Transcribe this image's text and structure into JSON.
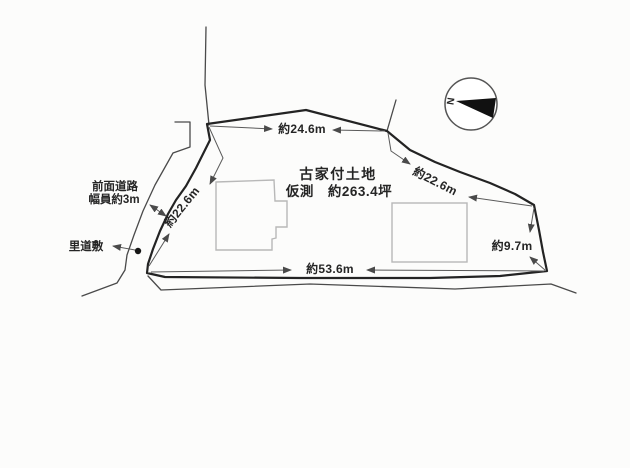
{
  "diagram": {
    "title": "土地区画図",
    "center_label": {
      "line1": "古家付土地",
      "line2": "仮測　約263.4坪"
    },
    "dimensions": {
      "top": "約24.6m",
      "left_edge": "約22.6m",
      "right_edge": "約22.6m",
      "right_short": "約9.7m",
      "bottom": "約53.6m"
    },
    "roads": {
      "front_road_line1": "前面道路",
      "front_road_line2": "幅員約3m",
      "rido_label": "里道敷"
    },
    "compass": {
      "north_label": "N"
    },
    "colors": {
      "background": "#fcfcfb",
      "plot_outline": "#232323",
      "road_line": "#4a4a4a",
      "building_outline": "#b8b8b8",
      "dimension_line": "#5a5a5a",
      "text": "#252525",
      "compass_needle": "#111111"
    }
  }
}
